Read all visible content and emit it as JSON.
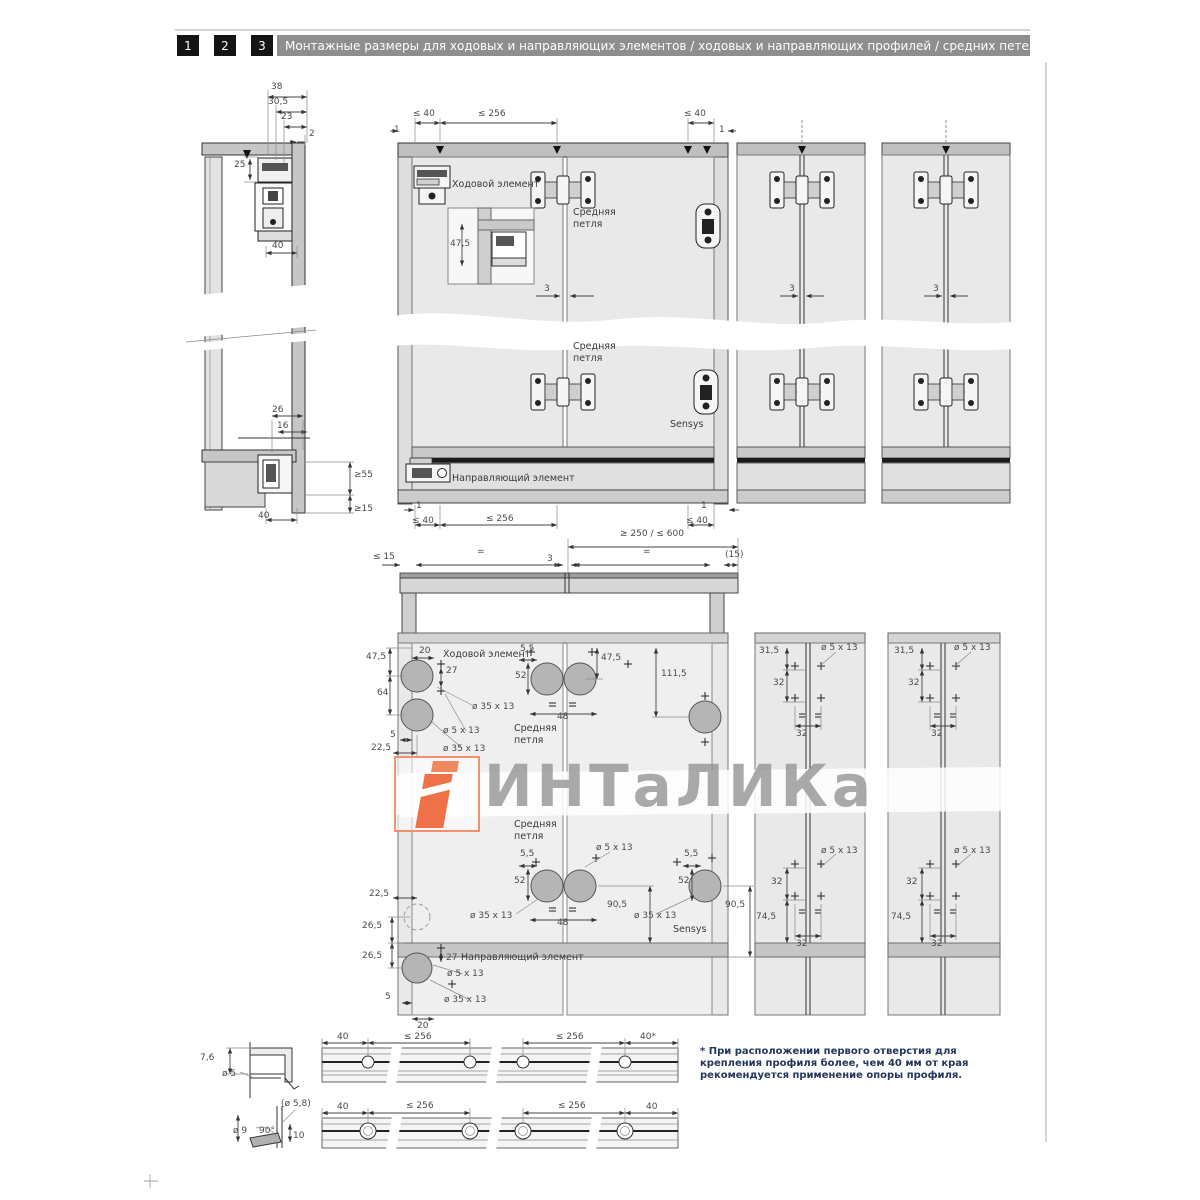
{
  "header": {
    "steps": [
      "1",
      "2",
      "3"
    ],
    "title": "Монтажные размеры для ходовых и направляющих элементов / ходовых и направляющих профилей / средних петель"
  },
  "side": {
    "d38": "38",
    "d30_5": "30,5",
    "d23": "23",
    "d2": "2",
    "d25": "25",
    "d40_top": "40",
    "d26": "26",
    "d16": "16",
    "ge55": "≥55",
    "ge15": "≥15",
    "d40_bottom": "40"
  },
  "front": {
    "runner": "Ходовой элемент",
    "middle_hinge": "Средняя петля",
    "sensys": "Sensys",
    "guide": "Направляющий элемент",
    "one": "1",
    "le40": "≤ 40",
    "le256": "≤ 256",
    "d47_5": "47,5",
    "d3": "3"
  },
  "top_view": {
    "range": "≥ 250 / ≤ 600",
    "le15": "≤ 15",
    "eq": "=",
    "d3": "3",
    "p15": "(15)"
  },
  "drill": {
    "runner": "Ходовой элемент",
    "middle_hinge": "Средняя петля",
    "guide": "Направляющий элемент",
    "sensys": "Sensys",
    "d47_5": "47,5",
    "d20": "20",
    "d27": "27",
    "d64": "64",
    "d5": "5",
    "d22_5": "22,5",
    "d5_5": "5,5",
    "d52": "52",
    "d48": "48",
    "d111_5": "111,5",
    "d90_5": "90,5",
    "d26_5": "26,5",
    "hole5": "ø 5 x 13",
    "hole35": "ø 35 x 13"
  },
  "columns": {
    "d31_5": "31,5",
    "d32": "32",
    "d74_5": "74,5",
    "hole5": "ø 5 x 13"
  },
  "profile1": {
    "d7_6": "7,6",
    "dia5": "ø 5",
    "d40": "40",
    "le256": "≤ 256",
    "d40_star": "40*"
  },
  "profile2": {
    "dia5_8": "(ø 5,8)",
    "dia9": "ø 9",
    "deg90": "90°",
    "d10": "10",
    "d40": "40",
    "le256": "≤ 256"
  },
  "footnote": {
    "text": "* При расположении первого отверстия для крепления профиля более, чем 40 мм от края рекомендуется применение опоры профиля."
  },
  "watermark": {
    "text": "ИНТаЛИКа"
  }
}
